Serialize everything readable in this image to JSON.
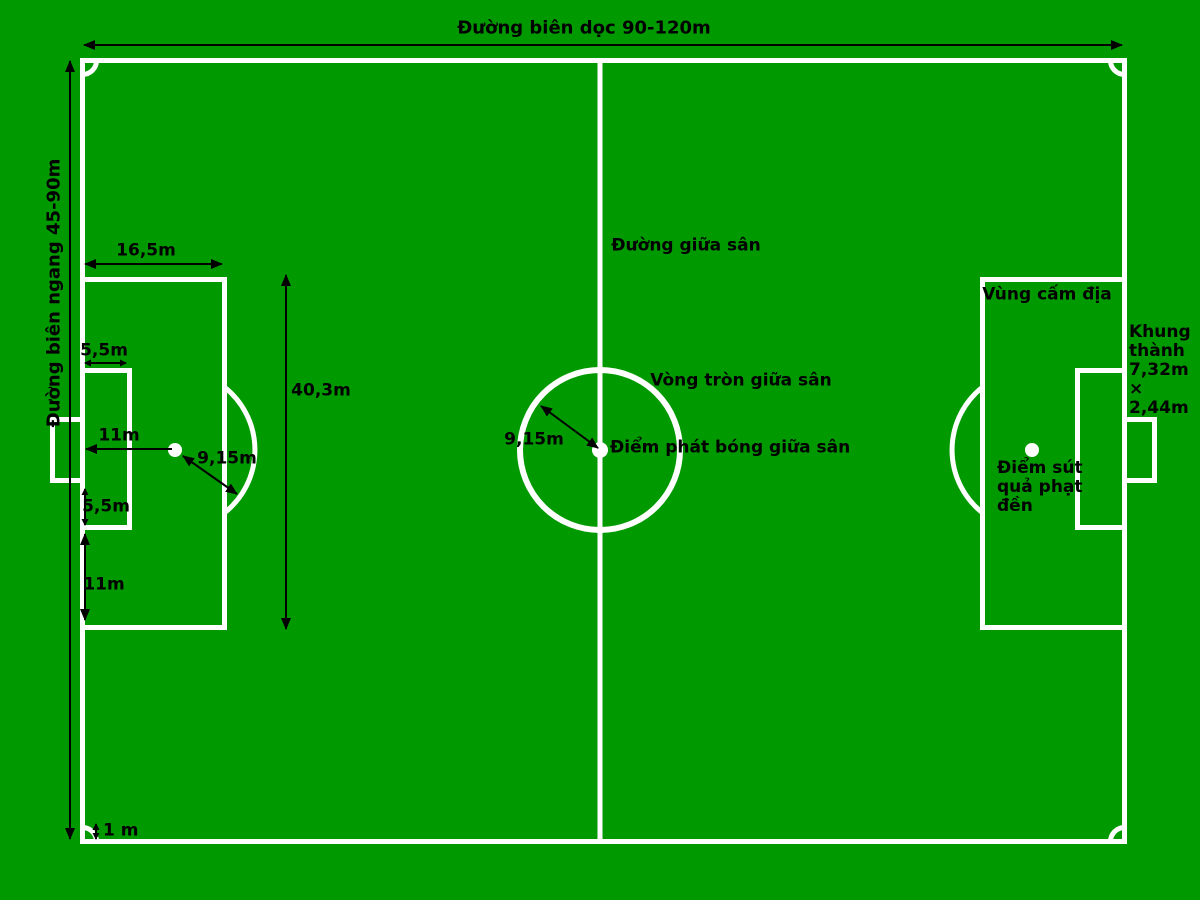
{
  "title": "Football pitch dimensions diagram (Vietnamese)",
  "colors": {
    "field_green": "#009a00",
    "line_white": "#ffffff",
    "annotation_black": "#000000"
  },
  "boundaries": {
    "touchline_label": "Đường biên dọc 90-120m",
    "goal_line_label": "Đường biên ngang 45-90m"
  },
  "dimensions": {
    "penalty_area_depth": "16,5m",
    "goal_area_depth": "5,5m",
    "penalty_mark_distance": "11m",
    "penalty_arc_radius": "9,15m",
    "goal_to_goal_area_side": "5,5m",
    "goal_area_to_penalty_edge": "11m",
    "penalty_area_width": "40,3m",
    "center_circle_radius": "9,15m",
    "corner_arc_radius": "1 m"
  },
  "features": {
    "halfway_line": "Đường giữa sân",
    "center_circle": "Vòng tròn giữa sân",
    "center_spot": "Điểm phát bóng giữa sân",
    "penalty_area": "Vùng cấm địa",
    "goal_frame_lines": [
      "Khung",
      "thành",
      "7,32m",
      "×",
      "2,44m"
    ],
    "penalty_spot_lines": [
      "Điểm sút",
      "quả phạt",
      "đền"
    ]
  }
}
